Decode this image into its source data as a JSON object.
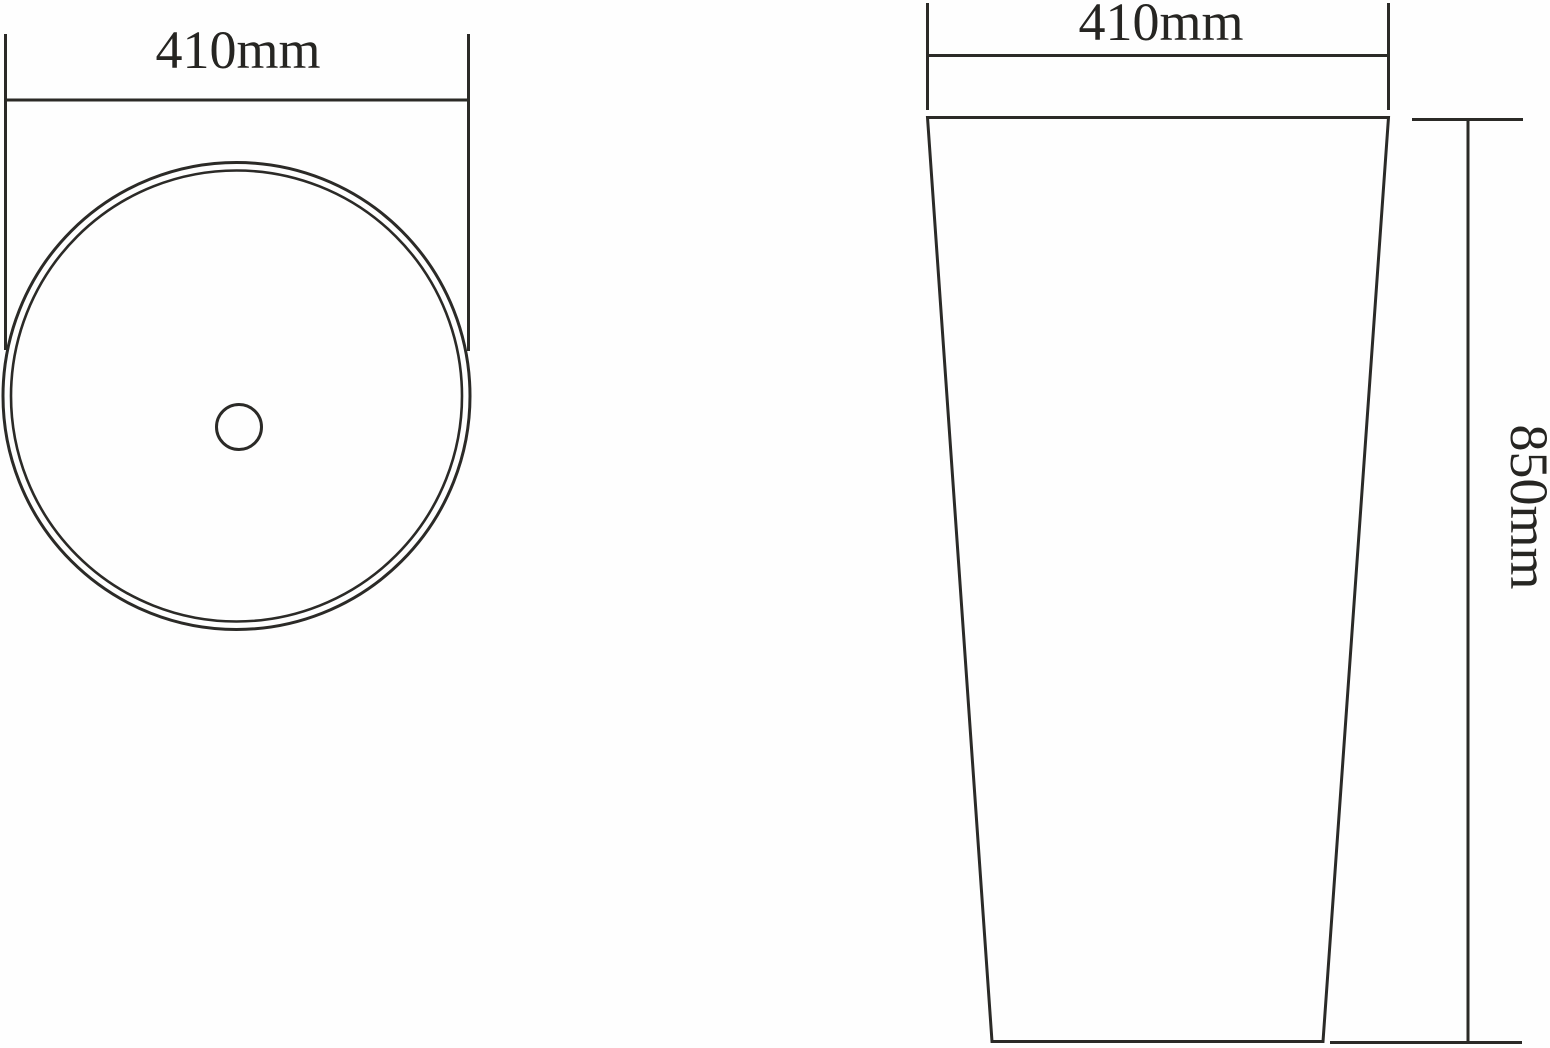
{
  "views": {
    "plan": {
      "width_label": "410mm"
    },
    "front": {
      "width_label": "410mm",
      "height_label": "850mm"
    }
  },
  "colors": {
    "line": "#2b2a27",
    "text": "#262522",
    "background": "#fefefe"
  }
}
